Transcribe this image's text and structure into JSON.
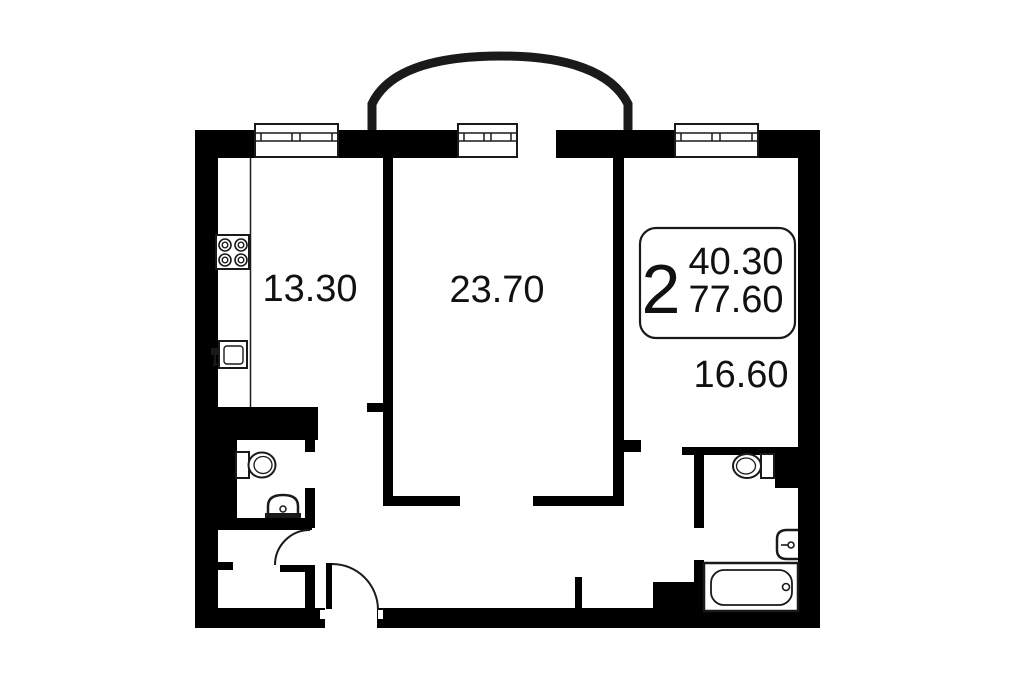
{
  "plan": {
    "type": "apartment-floor-plan",
    "rooms": [
      {
        "name": "kitchen",
        "area_label": "13.30"
      },
      {
        "name": "living-room",
        "area_label": "23.70"
      },
      {
        "name": "bedroom",
        "area_label": "16.60"
      }
    ],
    "summary_box": {
      "room_count": "2",
      "area_top": "40.30",
      "area_bottom": "77.60"
    },
    "fixture_icons": [
      "stove-icon",
      "kitchen-sink-icon",
      "wc-toilet-icon",
      "wc-sink-icon",
      "bath-toilet-icon",
      "bath-sink-icon",
      "bathtub-icon"
    ],
    "features": [
      "balcony-arch",
      "windows",
      "door-swing-arcs"
    ]
  },
  "colors": {
    "wall": "#000000",
    "background": "#ffffff",
    "line": "#1a1a1a",
    "text": "#111111"
  }
}
